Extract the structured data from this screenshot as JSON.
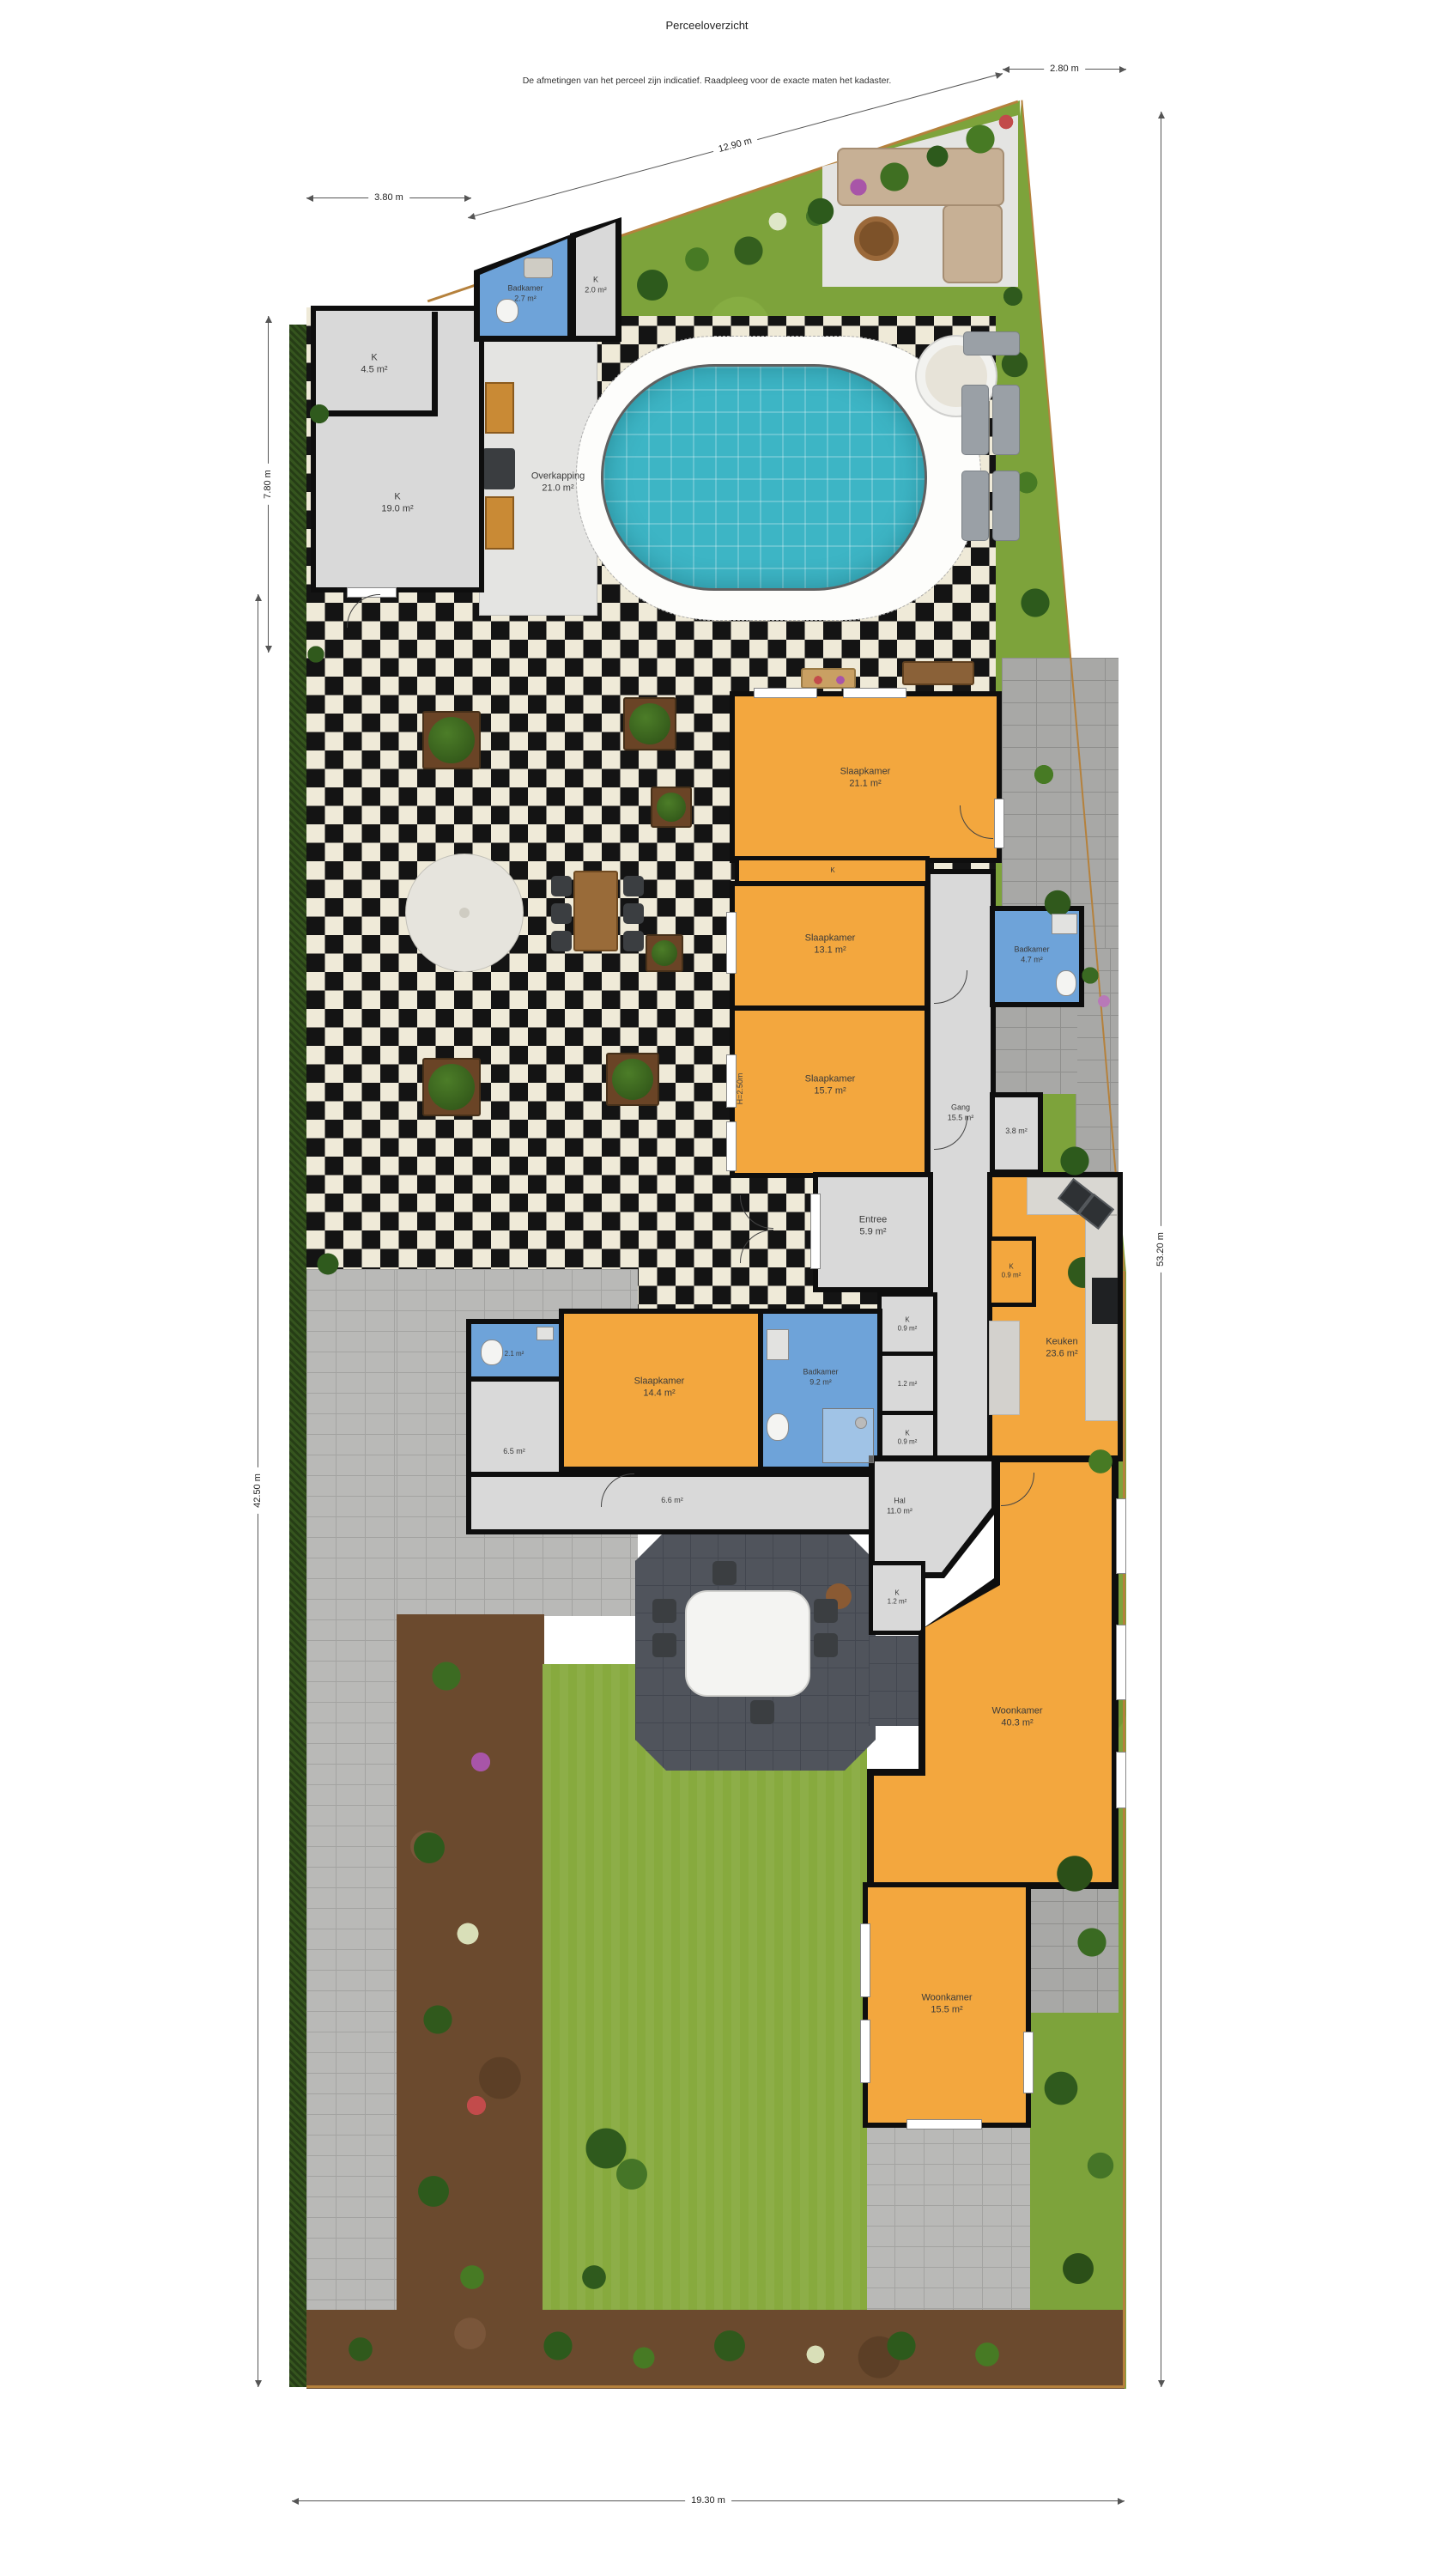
{
  "header": {
    "title": "Perceeloverzicht",
    "subtitle": "De afmetingen van het perceel zijn indicatief. Raadpleeg voor de exacte maten het kadaster."
  },
  "dimensions": {
    "top_left": "3.80 m",
    "top_diagonal": "12.90 m",
    "top_right": "2.80 m",
    "left_upper": "7.80 m",
    "left_lower": "42.50 m",
    "right_side": "53.20 m",
    "bottom": "19.30 m"
  },
  "annotations": {
    "ceiling_height": "H=2.50m"
  },
  "rooms": {
    "badkamer_boven": {
      "name": "Badkamer",
      "area": "2.7 m²"
    },
    "kast_2_0": {
      "name": "K",
      "area": "2.0 m²"
    },
    "kast_4_5": {
      "name": "K",
      "area": "4.5 m²"
    },
    "kast_19_0": {
      "name": "K",
      "area": "19.0 m²"
    },
    "overkapping": {
      "name": "Overkapping",
      "area": "21.0 m²"
    },
    "slaapkamer_21_1": {
      "name": "Slaapkamer",
      "area": "21.1 m²"
    },
    "kast_boven": {
      "name": "K",
      "area": ""
    },
    "slaapkamer_13_1": {
      "name": "Slaapkamer",
      "area": "13.1 m²"
    },
    "badkamer_4_7": {
      "name": "Badkamer",
      "area": "4.7 m²"
    },
    "slaapkamer_15_7": {
      "name": "Slaapkamer",
      "area": "15.7 m²"
    },
    "gang": {
      "name": "Gang",
      "area": "15.5 m²"
    },
    "berging_3_8": {
      "name": "",
      "area": "3.8 m²"
    },
    "entree": {
      "name": "Entree",
      "area": "5.9 m²"
    },
    "kast_keuken": {
      "name": "K",
      "area": "0.9 m²"
    },
    "keuken": {
      "name": "Keuken",
      "area": "23.6 m²"
    },
    "toilet_2_1": {
      "name": "",
      "area": "2.1 m²"
    },
    "slaapkamer_14_4": {
      "name": "Slaapkamer",
      "area": "14.4 m²"
    },
    "badkamer_9_2": {
      "name": "Badkamer",
      "area": "9.2 m²"
    },
    "ruimte_6_5": {
      "name": "",
      "area": "6.5 m²"
    },
    "ruimte_6_6": {
      "name": "",
      "area": "6.6 m²"
    },
    "kast_0_9_a": {
      "name": "K",
      "area": "0.9 m²"
    },
    "ruimte_1_2": {
      "name": "",
      "area": "1.2 m²"
    },
    "kast_0_9_b": {
      "name": "K",
      "area": "0.9 m²"
    },
    "hal": {
      "name": "Hal",
      "area": "11.0 m²"
    },
    "kast_1_2": {
      "name": "K",
      "area": "1.2 m²"
    },
    "woonkamer_40_3": {
      "name": "Woonkamer",
      "area": "40.3 m²"
    },
    "woonkamer_15_5": {
      "name": "Woonkamer",
      "area": "15.5 m²"
    }
  },
  "colors": {
    "room_orange": "#f3a73e",
    "room_blue": "#6ea3d9",
    "room_gray": "#d9d9d9",
    "wall": "#0e0e0e",
    "pool": "#3db5c5",
    "grass": "#87aa3e",
    "hedge": "#35551e",
    "tile_dark": "#141414",
    "tile_light": "#efead8",
    "fence": "#b5813c"
  }
}
